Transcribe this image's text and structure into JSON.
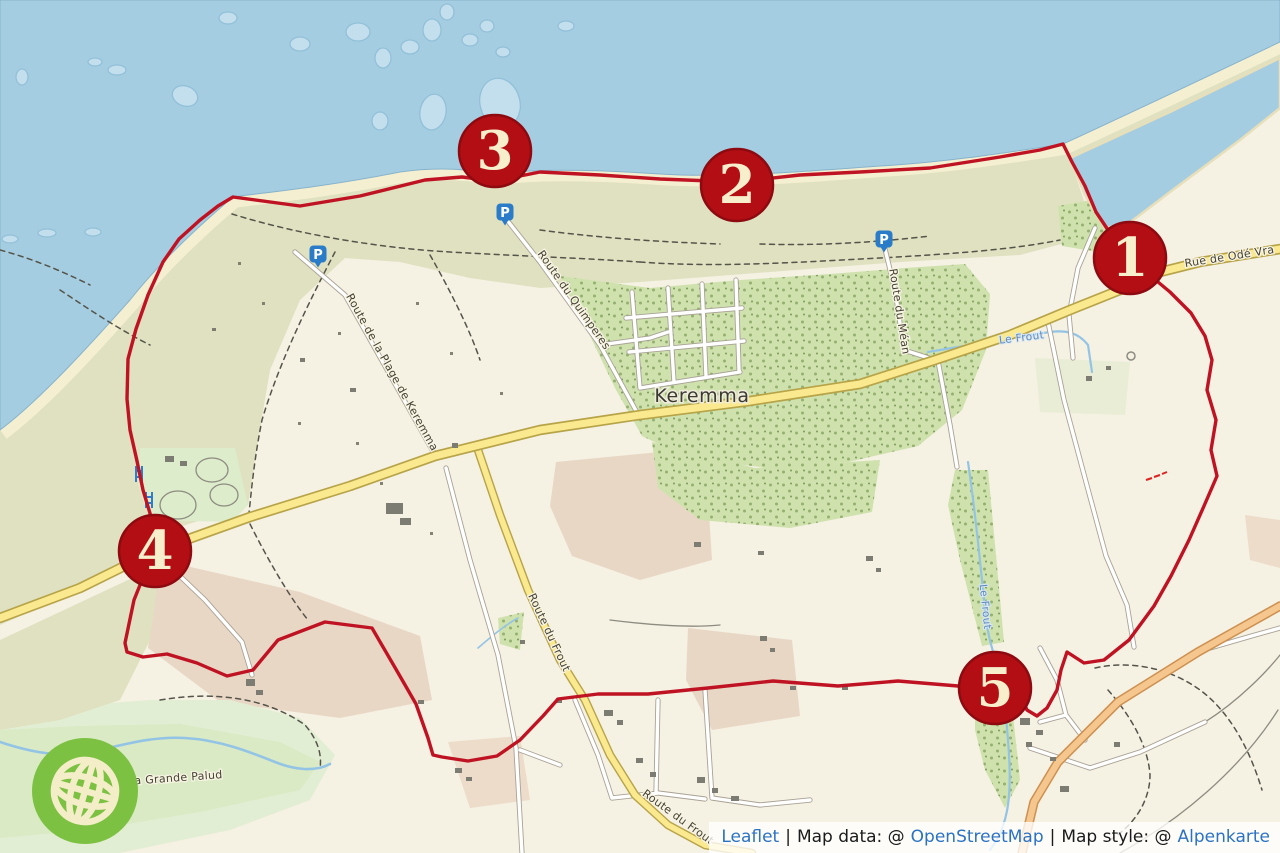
{
  "map": {
    "place_labels": [
      {
        "text": "Keremma"
      }
    ],
    "road_labels": [
      {
        "text": "Rue de Odé Vra"
      },
      {
        "text": "Route de la Plage de Keremma"
      },
      {
        "text": "Route du Quimperes"
      },
      {
        "text": "Route du Méan"
      },
      {
        "text": "Route du Frout"
      },
      {
        "text": "Route du Frout"
      },
      {
        "text": "de la Grande Palud"
      }
    ],
    "water_labels": [
      {
        "text": "Le Frout"
      },
      {
        "text": "Le Frout"
      }
    ],
    "markers": [
      {
        "label": "1"
      },
      {
        "label": "2"
      },
      {
        "label": "3"
      },
      {
        "label": "4"
      },
      {
        "label": "5"
      }
    ],
    "parking_label": "P",
    "colors": {
      "sea": "#a5cde1",
      "sandbank": "#c3dfee",
      "land": "#f5f1e3",
      "dune": "#dfe1c0",
      "forest": "#cfe2ad",
      "beach": "#f5efd1",
      "primary_road": "#fae98f",
      "tertiary_road": "#f5c78e",
      "route_red": "#bf1323",
      "marker_red": "#b30e14",
      "marker_text": "#f7eecb",
      "parking_blue": "#2a7cc9",
      "logo_green": "#7cc142",
      "link_blue": "#2b72c3"
    }
  },
  "attribution": {
    "leaflet_link": "Leaflet",
    "separator": "|",
    "map_data_label": "Map data: @",
    "map_data_link": "OpenStreetMap",
    "map_style_label": "Map style: @",
    "map_style_link": "Alpenkarte"
  }
}
